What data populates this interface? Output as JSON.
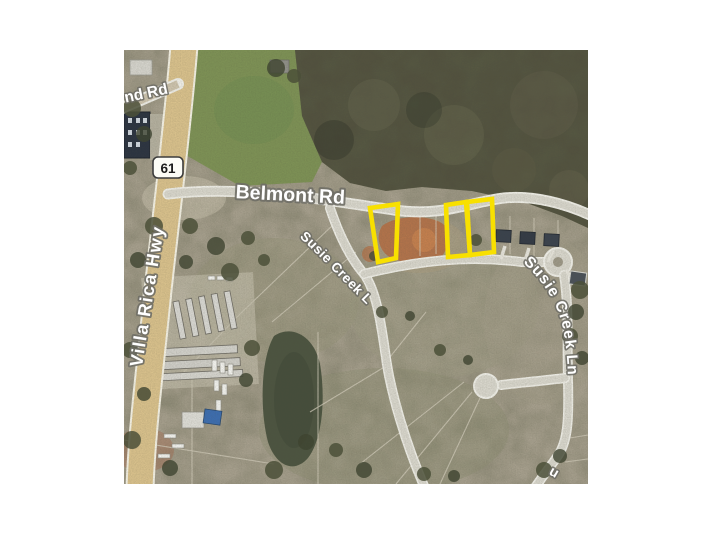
{
  "page": {
    "background": "#ffffff"
  },
  "map": {
    "kind": "aerial-photo-parcel-map",
    "labels": {
      "partial_road_top_left": "nd Rd",
      "highway_shield": "61",
      "belmont_road": "Belmont Rd",
      "villa_rica_hwy": "Villa Rica Hwy",
      "susie_creek_left": "Susie Creek Ln",
      "susie_creek_right": "Susie Creek Ln",
      "bottom_edge_fragment": "u"
    },
    "highlights": {
      "color": "#f8e000",
      "count": 3,
      "description": "Three vacant lots outlined in yellow south of Belmont Rd along Susie Creek Ln"
    },
    "colors": {
      "page_bg": "#ffffff",
      "land": "#a69f8d",
      "forest": "#53523f",
      "field_green": "#7d9155",
      "road_gray": "#d9d7cd",
      "road_casing": "#efeee7",
      "highway_tan": "#d9c18c",
      "pond": "#4c5440",
      "dirt": "#b46f45",
      "label_halo": "#6f6e66"
    }
  }
}
